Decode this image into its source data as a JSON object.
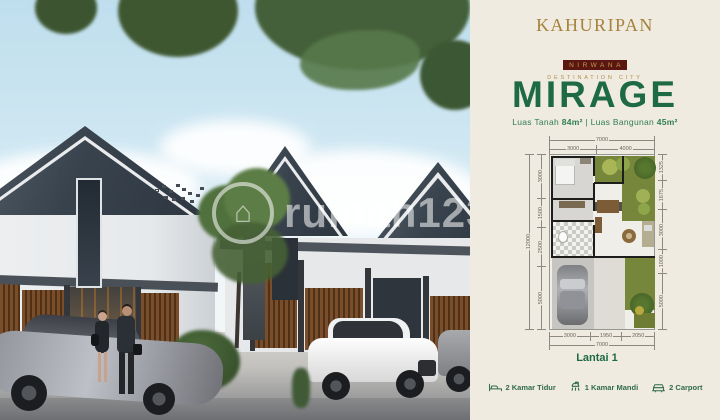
{
  "brand": {
    "name": "KAHURIPAN",
    "subname": "NIRWANA",
    "tagline": "DESTINATION CITY",
    "gold": "#a5823c",
    "maroon": "#5a1712"
  },
  "product": {
    "title": "MIRAGE",
    "accent_green": "#1d6a44",
    "specs": {
      "land_label": "Luas Tanah",
      "land_value": "84m²",
      "divider": "|",
      "building_label": "Luas Bangunan",
      "building_value": "45m²"
    }
  },
  "floorplan": {
    "caption": "Lantai 1",
    "dimensions": {
      "top_total": [
        "7000"
      ],
      "top_segments": [
        "3000",
        "4000"
      ],
      "left_total": [
        "12000"
      ],
      "left_segments": [
        "3000",
        "1500",
        "2500",
        "5000"
      ],
      "right_segments": [
        "1325",
        "1675",
        "3000",
        "1000",
        "5000"
      ],
      "bottom_segments": [
        "3000",
        "1950",
        "2050"
      ],
      "bottom_total": [
        "7000"
      ]
    }
  },
  "features": [
    {
      "icon": "bed-icon",
      "label": "2 Kamar Tidur"
    },
    {
      "icon": "shower-icon",
      "label": "1 Kamar Mandi"
    },
    {
      "icon": "car-icon",
      "label": "2 Carport"
    }
  ],
  "watermark": {
    "text": "rumah123"
  },
  "panel_bg": "#f0ebe0"
}
